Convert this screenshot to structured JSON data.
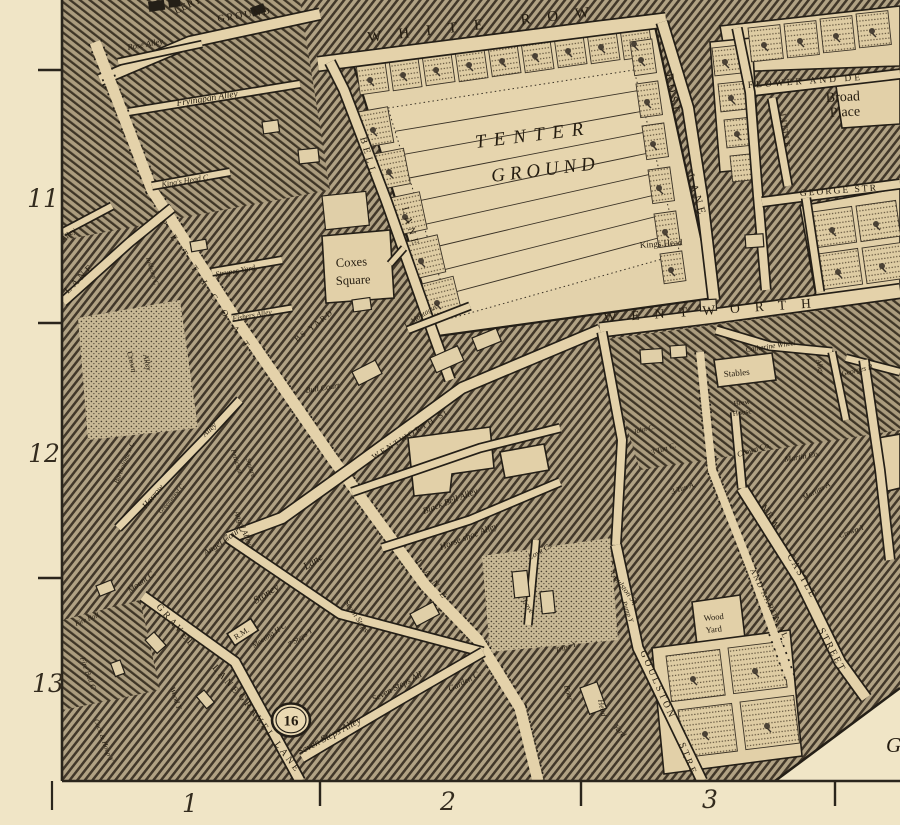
{
  "map_description": "Engraved street map sheet, Spitalfields / Petticoat Lane area",
  "colors": {
    "parchment": "#f0e5c6",
    "street": "#e4d2aa",
    "ink": "#241f17",
    "hatch_bg": "#b1a284",
    "hatch_line": "#42382a",
    "tenter_fill": "#e6d5ae"
  },
  "plate_badge": {
    "label": "16",
    "x": 291,
    "y": 720
  },
  "margins": {
    "left_numbers": [
      {
        "label": "11",
        "x": 43,
        "y": 207
      },
      {
        "label": "12",
        "x": 44,
        "y": 462
      },
      {
        "label": "13",
        "x": 48,
        "y": 692
      }
    ],
    "bottom_numbers": [
      {
        "label": "1",
        "x": 190,
        "y": 812
      },
      {
        "label": "2",
        "x": 448,
        "y": 810
      },
      {
        "label": "3",
        "x": 710,
        "y": 808
      }
    ]
  },
  "labels": [
    {
      "t": "LERY",
      "x": 176,
      "y": 14,
      "r": -25,
      "s": 10,
      "st": "c",
      "ls": 1
    },
    {
      "t": "GROUND",
      "x": 218,
      "y": 22,
      "r": -9,
      "s": 10,
      "st": "c",
      "ls": 2
    },
    {
      "t": "WHITE ROW",
      "x": 368,
      "y": 42,
      "r": -6.5,
      "s": 15,
      "st": "c",
      "ls": 17
    },
    {
      "t": "TENTER",
      "x": 476,
      "y": 148,
      "r": -7,
      "s": 19,
      "st": "ci",
      "ls": 8
    },
    {
      "t": "GROUND",
      "x": 492,
      "y": 182,
      "r": -7,
      "s": 19,
      "st": "ci",
      "ls": 5
    },
    {
      "t": "ROSE",
      "x": 666,
      "y": 74,
      "r": 80,
      "s": 11,
      "st": "c",
      "ls": 4
    },
    {
      "t": "LANE",
      "x": 687,
      "y": 175,
      "r": 73,
      "s": 11,
      "st": "c",
      "ls": 4
    },
    {
      "t": "FLOWER AND DE",
      "x": 748,
      "y": 88,
      "r": -4,
      "s": 9.5,
      "st": "c",
      "ls": 3
    },
    {
      "t": "Broad",
      "x": 826,
      "y": 102,
      "r": -3,
      "s": 14,
      "st": "r",
      "ls": 0
    },
    {
      "t": "Place",
      "x": 830,
      "y": 117,
      "r": -3,
      "s": 14,
      "st": "r",
      "ls": 0
    },
    {
      "t": "LITTLE",
      "x": 780,
      "y": 114,
      "r": 82,
      "s": 8.5,
      "st": "c",
      "ls": 1
    },
    {
      "t": "GEORGE STR",
      "x": 800,
      "y": 196,
      "r": -4,
      "s": 9.5,
      "st": "c",
      "ls": 2
    },
    {
      "t": "WENTWORTH",
      "x": 604,
      "y": 322,
      "r": -4,
      "s": 13.5,
      "st": "c",
      "ls": 15
    },
    {
      "t": "Kings Head",
      "x": 640,
      "y": 248,
      "r": -4,
      "s": 9,
      "st": "r",
      "ls": 0
    },
    {
      "t": "Rose Alley",
      "x": 128,
      "y": 50,
      "r": -10,
      "s": 8.5,
      "st": "i",
      "ls": 0
    },
    {
      "t": "Fryingpan Alley",
      "x": 177,
      "y": 106,
      "r": -9,
      "s": 9.5,
      "st": "i",
      "ls": 0
    },
    {
      "t": "King's Head C",
      "x": 162,
      "y": 187,
      "r": -9,
      "s": 8,
      "st": "i",
      "ls": 0
    },
    {
      "t": "Strypes Yard",
      "x": 216,
      "y": 277,
      "r": -10,
      "s": 8,
      "st": "i",
      "ls": 0
    },
    {
      "t": "Fishers Alley",
      "x": 233,
      "y": 321,
      "r": -10,
      "s": 7.5,
      "st": "i",
      "ls": 0
    },
    {
      "t": "Alley",
      "x": 64,
      "y": 242,
      "r": -42,
      "s": 8,
      "st": "i",
      "ls": 0
    },
    {
      "t": "LANE",
      "x": 68,
      "y": 294,
      "r": -45,
      "s": 10,
      "st": "c",
      "ls": 3
    },
    {
      "t": "PETTICOAT",
      "x": 160,
      "y": 222,
      "r": 56,
      "s": 9,
      "st": "c",
      "ls": 13
    },
    {
      "t": "LANE",
      "x": 416,
      "y": 562,
      "r": 54,
      "s": 9,
      "st": "c",
      "ls": 7
    },
    {
      "t": "Inkhorn C",
      "x": 146,
      "y": 258,
      "r": 73,
      "s": 7,
      "st": "i",
      "ls": 0
    },
    {
      "t": "Crown",
      "x": 127,
      "y": 352,
      "r": 77,
      "s": 8,
      "st": "i",
      "ls": 0
    },
    {
      "t": "Alley",
      "x": 143,
      "y": 355,
      "r": 77,
      "s": 8,
      "st": "i",
      "ls": 0
    },
    {
      "t": "Coxes",
      "x": 336,
      "y": 267,
      "r": -3,
      "s": 12.5,
      "st": "r",
      "ls": 0
    },
    {
      "t": "Square",
      "x": 336,
      "y": 285,
      "r": -3,
      "s": 12.5,
      "st": "r",
      "ls": 0
    },
    {
      "t": "BS YARD",
      "x": 297,
      "y": 342,
      "r": -38,
      "s": 8,
      "st": "c",
      "ls": 2
    },
    {
      "t": "L. Montague",
      "x": 406,
      "y": 328,
      "r": -33,
      "s": 7.5,
      "st": "i",
      "ls": 0
    },
    {
      "t": "Bull Court",
      "x": 306,
      "y": 393,
      "r": -9,
      "s": 8,
      "st": "i",
      "ls": 0
    },
    {
      "t": "BELL",
      "x": 360,
      "y": 138,
      "r": 74,
      "s": 10,
      "st": "c",
      "ls": 4
    },
    {
      "t": "LANE",
      "x": 402,
      "y": 208,
      "r": 74,
      "s": 10,
      "st": "c",
      "ls": 4
    },
    {
      "t": "WENTWORTH St",
      "x": 374,
      "y": 460,
      "r": -32,
      "s": 8.5,
      "st": "c",
      "ls": 2
    },
    {
      "t": "Harrow",
      "x": 146,
      "y": 509,
      "r": -50,
      "s": 9,
      "st": "i",
      "ls": 0
    },
    {
      "t": "Alley",
      "x": 205,
      "y": 437,
      "r": -43,
      "s": 8,
      "st": "i",
      "ls": 0
    },
    {
      "t": "Bartholomew C",
      "x": 118,
      "y": 484,
      "r": -68,
      "s": 7,
      "st": "i",
      "ls": 0
    },
    {
      "t": "Greenwood C",
      "x": 161,
      "y": 514,
      "r": -50,
      "s": 6.5,
      "st": "i",
      "ls": 0
    },
    {
      "t": "Petticoat",
      "x": 231,
      "y": 450,
      "r": 73,
      "s": 7,
      "st": "i",
      "ls": 0
    },
    {
      "t": "Square",
      "x": 246,
      "y": 459,
      "r": 73,
      "s": 7,
      "st": "i",
      "ls": 0
    },
    {
      "t": "Angel Court",
      "x": 206,
      "y": 556,
      "r": -35,
      "s": 9,
      "st": "i",
      "ls": 0
    },
    {
      "t": "Angel Alley",
      "x": 234,
      "y": 512,
      "r": 68,
      "s": 8,
      "st": "i",
      "ls": 0
    },
    {
      "t": "Mount C.",
      "x": 130,
      "y": 593,
      "r": -35,
      "s": 8.5,
      "st": "i",
      "ls": 0
    },
    {
      "t": "Stoney",
      "x": 256,
      "y": 604,
      "r": -33,
      "s": 10.5,
      "st": "i",
      "ls": 0
    },
    {
      "t": "Lane",
      "x": 306,
      "y": 570,
      "r": -33,
      "s": 10.5,
      "st": "i",
      "ls": 0
    },
    {
      "t": "Meeting H C",
      "x": 254,
      "y": 648,
      "r": -33,
      "s": 7.5,
      "st": "i",
      "ls": 0
    },
    {
      "t": "R.M.",
      "x": 236,
      "y": 640,
      "r": -33,
      "s": 8,
      "st": "r",
      "ls": 0,
      "box": true
    },
    {
      "t": "7 Steps Y",
      "x": 290,
      "y": 647,
      "r": -33,
      "s": 7.5,
      "st": "i",
      "ls": 0
    },
    {
      "t": "Fire Ball",
      "x": 76,
      "y": 626,
      "r": -22,
      "s": 7,
      "st": "i",
      "ls": 0
    },
    {
      "t": "Fire Ball C",
      "x": 80,
      "y": 658,
      "r": 70,
      "s": 7.5,
      "st": "i",
      "ls": 0
    },
    {
      "t": "Cock & Hoop Y",
      "x": 94,
      "y": 720,
      "r": 70,
      "s": 7,
      "st": "i",
      "ls": 0
    },
    {
      "t": "GRAVEL",
      "x": 156,
      "y": 607,
      "r": 49,
      "s": 9.5,
      "st": "c",
      "ls": 3
    },
    {
      "t": "LANE",
      "x": 212,
      "y": 668,
      "r": 49,
      "s": 9.5,
      "st": "c",
      "ls": 3
    },
    {
      "t": "GRAVEL LANE",
      "x": 238,
      "y": 696,
      "r": 53,
      "s": 9.5,
      "st": "c",
      "ls": 3
    },
    {
      "t": "Wood Y",
      "x": 170,
      "y": 688,
      "r": 72,
      "s": 7.5,
      "st": "i",
      "ls": 0
    },
    {
      "t": "Seven Steps",
      "x": 344,
      "y": 602,
      "r": 56,
      "s": 8,
      "st": "i",
      "ls": 0
    },
    {
      "t": "Seven Steps All",
      "x": 374,
      "y": 702,
      "r": -28,
      "s": 9,
      "st": "i",
      "ls": 0
    },
    {
      "t": "Seven Steps Alley",
      "x": 300,
      "y": 755,
      "r": -28,
      "s": 10,
      "st": "i",
      "ls": 0
    },
    {
      "t": "Garden C.",
      "x": 450,
      "y": 692,
      "r": -28,
      "s": 8.5,
      "st": "i",
      "ls": 0
    },
    {
      "t": "Black Bell Alley",
      "x": 424,
      "y": 514,
      "r": -21,
      "s": 9,
      "st": "i",
      "ls": 0
    },
    {
      "t": "Horse shoe Alley",
      "x": 441,
      "y": 550,
      "r": -21,
      "s": 9,
      "st": "i",
      "ls": 0
    },
    {
      "t": "Love C.",
      "x": 530,
      "y": 560,
      "r": -30,
      "s": 8,
      "st": "i",
      "ls": 0
    },
    {
      "t": "Love",
      "x": 522,
      "y": 601,
      "r": 58,
      "s": 8,
      "st": "i",
      "ls": 0
    },
    {
      "t": "Tripe Y.",
      "x": 556,
      "y": 653,
      "r": -18,
      "s": 7.5,
      "st": "i",
      "ls": 0
    },
    {
      "t": "Boar",
      "x": 564,
      "y": 686,
      "r": 74,
      "s": 8,
      "st": "i",
      "ls": 0
    },
    {
      "t": "Head",
      "x": 598,
      "y": 700,
      "r": 78,
      "s": 8,
      "st": "i",
      "ls": 0
    },
    {
      "t": "Yard",
      "x": 613,
      "y": 727,
      "r": 48,
      "s": 8,
      "st": "i",
      "ls": 0
    },
    {
      "t": "Pump Y",
      "x": 622,
      "y": 602,
      "r": 70,
      "s": 7,
      "st": "i",
      "ls": 0
    },
    {
      "t": "Goulston Sq",
      "x": 610,
      "y": 574,
      "r": 52,
      "s": 8,
      "st": "i",
      "ls": 0
    },
    {
      "t": "GOULSTON",
      "x": 640,
      "y": 652,
      "r": 66,
      "s": 9.5,
      "st": "c",
      "ls": 3
    },
    {
      "t": "STRE",
      "x": 679,
      "y": 744,
      "r": 68,
      "s": 9.5,
      "st": "c",
      "ls": 3
    },
    {
      "t": "Wood",
      "x": 704,
      "y": 621,
      "r": -6,
      "s": 8.5,
      "st": "r",
      "ls": 0
    },
    {
      "t": "Yard",
      "x": 706,
      "y": 633,
      "r": -6,
      "s": 8.5,
      "st": "r",
      "ls": 0
    },
    {
      "t": "AND AARON AL",
      "x": 750,
      "y": 570,
      "r": 64,
      "s": 8,
      "st": "c",
      "ls": 1.5
    },
    {
      "t": "NEW",
      "x": 760,
      "y": 507,
      "r": 56,
      "s": 10,
      "st": "c",
      "ls": 2
    },
    {
      "t": "CASTLE",
      "x": 787,
      "y": 556,
      "r": 60,
      "s": 10,
      "st": "c",
      "ls": 2
    },
    {
      "t": "STREET",
      "x": 818,
      "y": 630,
      "r": 62,
      "s": 10,
      "st": "c",
      "ls": 2
    },
    {
      "t": "3 Tun C.",
      "x": 652,
      "y": 455,
      "r": -18,
      "s": 7.5,
      "st": "i",
      "ls": 0
    },
    {
      "t": "3 Tun A.",
      "x": 672,
      "y": 494,
      "r": -18,
      "s": 7.5,
      "st": "i",
      "ls": 0
    },
    {
      "t": "John C.",
      "x": 634,
      "y": 434,
      "r": -14,
      "s": 7,
      "st": "i",
      "ls": 0
    },
    {
      "t": "Crown Co.",
      "x": 738,
      "y": 457,
      "r": -17,
      "s": 8,
      "st": "i",
      "ls": 0
    },
    {
      "t": "Martin Co.",
      "x": 785,
      "y": 462,
      "r": -10,
      "s": 8,
      "st": "i",
      "ls": 0
    },
    {
      "t": "Martins A",
      "x": 804,
      "y": 500,
      "r": -28,
      "s": 7.5,
      "st": "i",
      "ls": 0
    },
    {
      "t": "Crown Y",
      "x": 840,
      "y": 538,
      "r": -20,
      "s": 7.5,
      "st": "i",
      "ls": 0
    },
    {
      "t": "Brew",
      "x": 734,
      "y": 406,
      "r": -8,
      "s": 7.5,
      "st": "r",
      "ls": 0
    },
    {
      "t": "House",
      "x": 733,
      "y": 416,
      "r": -8,
      "s": 7.5,
      "st": "r",
      "ls": 0
    },
    {
      "t": "Stables",
      "x": 724,
      "y": 377,
      "r": -5,
      "s": 9,
      "st": "r",
      "ls": 0
    },
    {
      "t": "Catherine Wheel",
      "x": 746,
      "y": 352,
      "r": -8,
      "s": 7.5,
      "st": "i",
      "ls": 0
    },
    {
      "t": "Alley",
      "x": 816,
      "y": 360,
      "r": 76,
      "s": 7.5,
      "st": "i",
      "ls": 0
    },
    {
      "t": "Georges B",
      "x": 842,
      "y": 376,
      "r": -13,
      "s": 7.5,
      "st": "i",
      "ls": 0
    },
    {
      "t": "G",
      "x": 886,
      "y": 752,
      "r": 0,
      "s": 21,
      "st": "i",
      "ls": 0
    }
  ]
}
